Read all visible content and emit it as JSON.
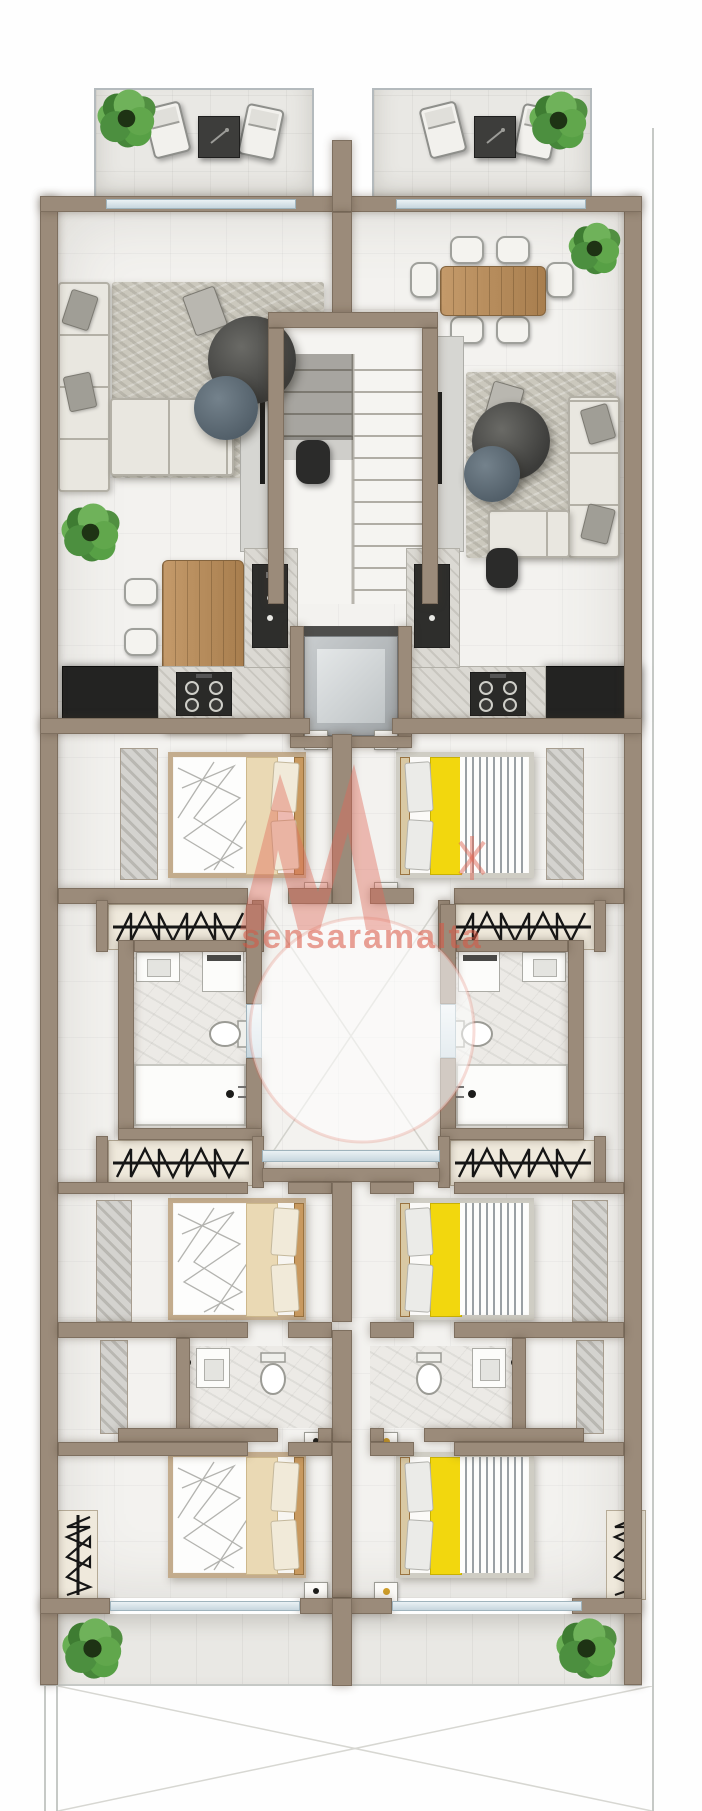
{
  "image_type": "architectural floor plan, top-down 3D render, two mirrored apartments",
  "watermark": {
    "text": "sensaramalta"
  },
  "palette": {
    "wall": "#9b8b7a",
    "walledge": "#7e6f5f",
    "floor": "#f3f2ef",
    "terrace": "#e9e8e4",
    "glass": "#c7d6de",
    "rug": "#cbc8bd",
    "sofa": "#e9e7e0",
    "wood": "#c49a6a",
    "counter": "#232322",
    "linen": "#ead9b4",
    "yellow": "#f2d70e",
    "salmon": "#e06a58",
    "plantgreen": "#57a045",
    "coffee_table_dark": "#454543",
    "coffee_table_slate": "#5a6771"
  },
  "floorplan": {
    "layout": "two mirrored apartments per floor around a central staircase and lift core; front terraces at top, rear balcony at bottom; unbuilt void areas marked with thin diagonal lines",
    "shared_core": {
      "staircase": {
        "location": "centre top",
        "flights": 2,
        "description": "U-shaped stair with central stringer"
      },
      "elevator": {
        "location": "centre, below staircase",
        "description": "grey lift car between flanking shaft walls"
      },
      "light_well": {
        "location": "centre, between bathrooms",
        "description": "open shaft marked with diagonal cross lines and glazing band"
      }
    },
    "apartment_left": {
      "rooms": [
        {
          "name": "front terrace",
          "furniture": [
            "sun lounger x2",
            "dark side table",
            "corner plant"
          ]
        },
        {
          "name": "living area",
          "furniture": [
            "L-shaped sofa",
            "textured rug",
            "round coffee table (dark)",
            "round coffee table (slate)",
            "pouf",
            "tv sideboard",
            "plant"
          ]
        },
        {
          "name": "dining area",
          "furniture": [
            "wooden 6-seat dining table",
            "white chairs x6"
          ]
        },
        {
          "name": "kitchen",
          "furniture": [
            "black tall units",
            "marble worktop",
            "4-burner hob",
            "dark sink unit"
          ]
        },
        {
          "name": "bedroom 1",
          "furniture": [
            "double bed (white duvet, cream blanket)",
            "nightstand x2",
            "built-in wardrobe"
          ]
        },
        {
          "name": "bathroom 1",
          "furniture": [
            "vanity with basin",
            "washing machine",
            "wall-hung toilet",
            "shower tray with drain"
          ]
        },
        {
          "name": "wardrobe runs",
          "furniture": [
            "hanger-rail wardrobe x3"
          ]
        },
        {
          "name": "bedroom 2",
          "furniture": [
            "double bed",
            "built-in wardrobe"
          ]
        },
        {
          "name": "bathroom 2",
          "furniture": [
            "vanity with basin",
            "toilet"
          ]
        },
        {
          "name": "bedroom 3",
          "furniture": [
            "double bed",
            "nightstand x2",
            "hanger-rail wardrobe"
          ]
        },
        {
          "name": "rear balcony",
          "furniture": [
            "corner plant"
          ]
        }
      ]
    },
    "apartment_right": {
      "rooms": [
        {
          "name": "front terrace",
          "furniture": [
            "sun lounger x2",
            "dark side table",
            "corner plant"
          ]
        },
        {
          "name": "dining area",
          "furniture": [
            "wooden 6-seat dining table",
            "white chairs x6",
            "plant"
          ]
        },
        {
          "name": "living area",
          "furniture": [
            "L-shaped sofa",
            "textured rug",
            "round coffee table (dark)",
            "round coffee table (slate)",
            "pouf",
            "tv sideboard"
          ]
        },
        {
          "name": "kitchen",
          "furniture": [
            "black tall units",
            "marble worktop",
            "4-burner hob",
            "dark sink unit"
          ]
        },
        {
          "name": "bedroom 1",
          "furniture": [
            "double bed (yellow blanket, striped duvet)",
            "nightstand x2",
            "built-in wardrobe"
          ]
        },
        {
          "name": "bathroom 1",
          "furniture": [
            "vanity with basin",
            "washing machine",
            "wall-hung toilet",
            "shower tray with drain"
          ]
        },
        {
          "name": "wardrobe runs",
          "furniture": [
            "hanger-rail wardrobe x3"
          ]
        },
        {
          "name": "bedroom 2",
          "furniture": [
            "double bed",
            "built-in wardrobe"
          ]
        },
        {
          "name": "bathroom 2",
          "furniture": [
            "vanity with basin",
            "toilet"
          ]
        },
        {
          "name": "bedroom 3",
          "furniture": [
            "double bed",
            "nightstand x2",
            "hanger-rail wardrobe"
          ]
        },
        {
          "name": "rear balcony",
          "furniture": [
            "corner plant"
          ]
        }
      ]
    },
    "plants_total": 6,
    "beds_total": 6,
    "text_labels_visible": [
      "sensaramalta"
    ]
  }
}
